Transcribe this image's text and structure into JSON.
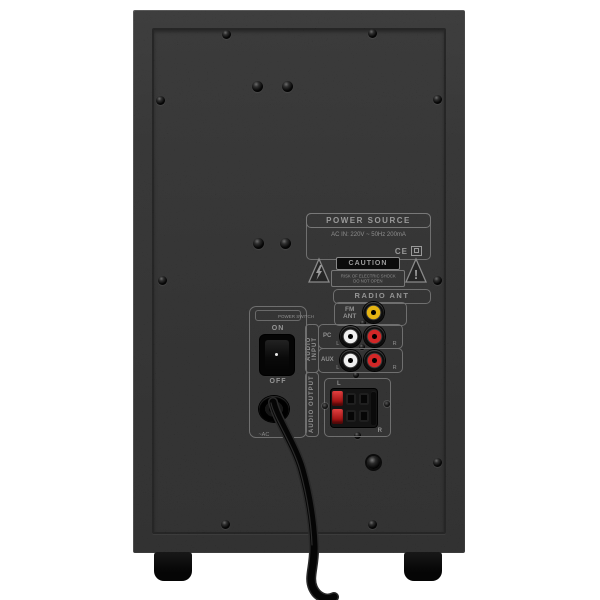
{
  "image": {
    "description": "Rear view of a black subwoofer speaker cabinet with connector panel, power cable and rubber feet",
    "background": "#ffffff"
  },
  "panel": {
    "power_source": {
      "title": "POWER SOURCE",
      "spec": "AC IN: 220V ~ 50Hz   200mA",
      "ce_mark": "CE"
    },
    "caution": {
      "title": "CAUTION",
      "line1": "RISK OF ELECTRIC SHOCK",
      "line2": "DO NOT OPEN"
    },
    "radio_ant": {
      "title": "RADIO ANT",
      "fm_line1": "FM",
      "fm_line2": "ANT"
    },
    "audio_input": {
      "label": "AUDIO INPUT",
      "rows": [
        {
          "name": "PC",
          "left_label": "L",
          "right_label": "R"
        },
        {
          "name": "AUX",
          "left_label": "L",
          "right_label": "R"
        }
      ]
    },
    "audio_output": {
      "label": "AUDIO OUTPUT",
      "top_label": "L",
      "bottom_label": "R"
    },
    "power_switch": {
      "label": "POWER SWITCH",
      "on": "ON",
      "off": "OFF",
      "ac": "~AC"
    }
  },
  "colors": {
    "cabinet": "#232323",
    "panel_outline": "#6f6f6f",
    "label_text": "#949494",
    "jack_yellow": "#e6b512",
    "jack_white": "#f0f0f0",
    "jack_red": "#d22727",
    "terminal_red": "#c32222",
    "background": "#ffffff"
  }
}
